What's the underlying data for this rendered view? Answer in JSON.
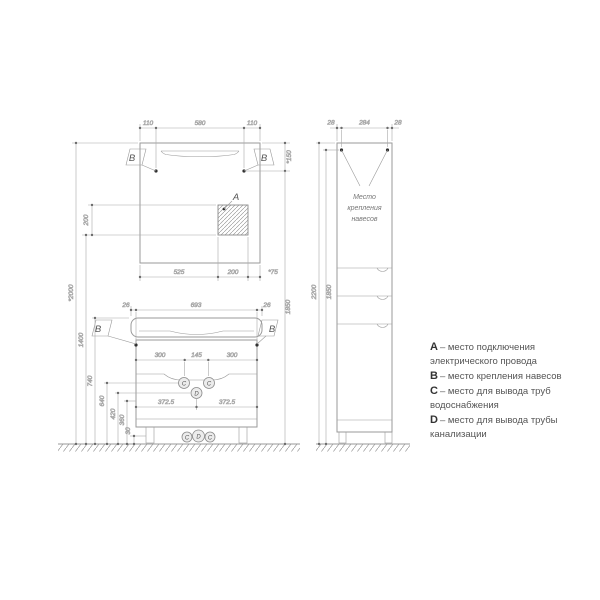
{
  "left_drawing": {
    "overall": {
      "total_height": "*2000",
      "outlet_height": "1400",
      "hanger_height": "1850"
    },
    "mirror": {
      "top_dims": [
        "110",
        "580",
        "110"
      ],
      "right_dim": "*150",
      "left_dim": "200",
      "bottom_dims": [
        "525",
        "200",
        "*75"
      ],
      "marker_a": "A",
      "marker_b_left": "B",
      "marker_b_right": "B"
    },
    "vanity": {
      "top_dims": [
        "26",
        "693",
        "26"
      ],
      "inner_dims": [
        "300",
        "145",
        "300"
      ],
      "half_dims": [
        "372.5",
        "372.5"
      ],
      "height_dims": [
        "740",
        "640",
        "420",
        "360",
        "30"
      ],
      "marker_b_left": "B",
      "marker_b_right": "B",
      "marker_c_left": "C",
      "marker_c_right": "C",
      "marker_d": "D",
      "bottom_marker_c_left": "C",
      "bottom_marker_d": "D",
      "bottom_marker_c_right": "C"
    }
  },
  "right_drawing": {
    "top_dims": [
      "28",
      "284",
      "28"
    ],
    "height_outer": "2200",
    "height_inner": "1850",
    "note_lines": [
      "Место",
      "крепления",
      "навесов"
    ]
  },
  "legend": {
    "items": [
      {
        "key": "A",
        "text": "– место подключения электрического провода"
      },
      {
        "key": "B",
        "text": "– место крепления навесов"
      },
      {
        "key": "C",
        "text": "– место для вывода труб водоснабжения"
      },
      {
        "key": "D",
        "text": "– место для вывода трубы канализации"
      }
    ]
  }
}
